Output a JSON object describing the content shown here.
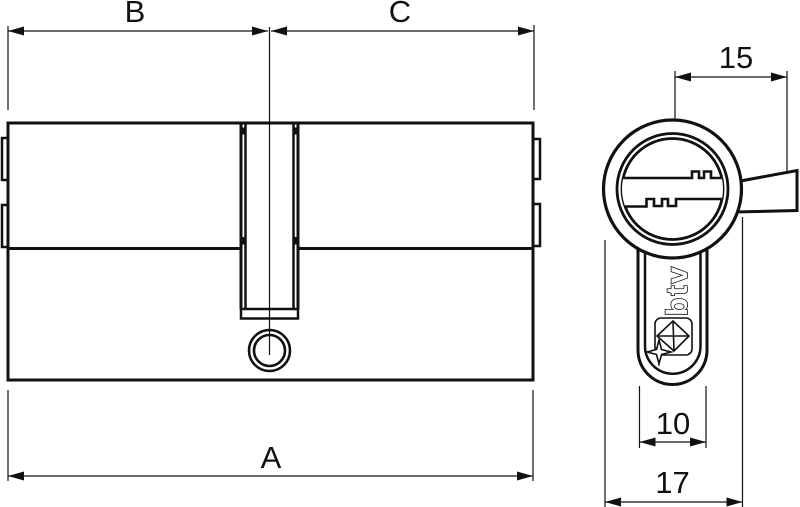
{
  "colors": {
    "background": "#ffffff",
    "line": "#111111"
  },
  "side_view": {
    "dim_top_left": "B",
    "dim_top_right": "C",
    "dim_bottom": "A"
  },
  "front_view": {
    "dim_top": "15",
    "dim_neck_width": "10",
    "dim_diameter": "17",
    "brand": "btv"
  }
}
